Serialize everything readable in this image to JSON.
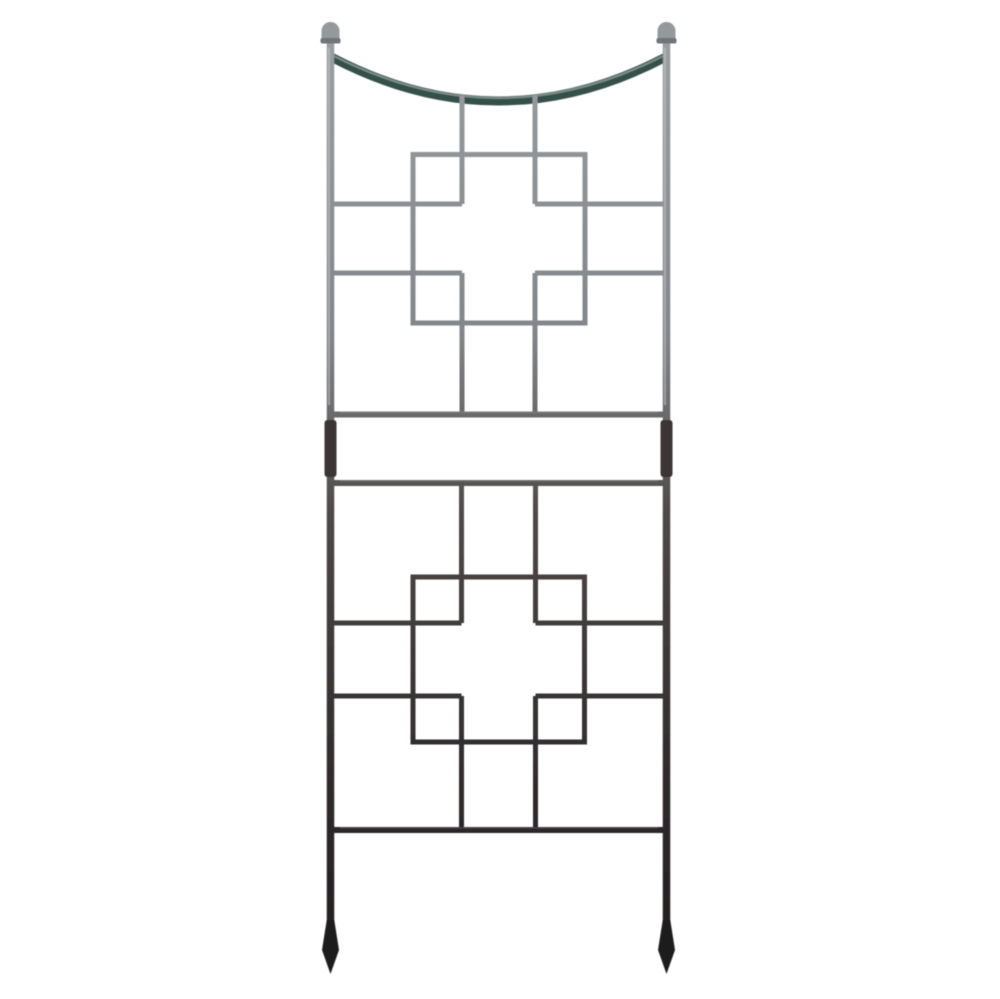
{
  "image": {
    "kind": "product-photo",
    "subject": "iron garden trellis",
    "alt": "Gunmetal iron garden trellis with dipped arched top, ball finials on two posts, two square-and-cross lattice panels, double middle rails with coupler sleeves, one bottom rail, and pointed spear feet",
    "background_color": "#ffffff"
  },
  "palette": {
    "metal_top": "#9da1a2",
    "metal_upper": "#83868a",
    "metal_mid": "#4d4847",
    "metal_lower": "#322e2f",
    "metal_bottom": "#1f1b1e",
    "arch": "#36504a",
    "arch_sheen": "#93a49d",
    "sheen": "#c9cdce",
    "rail_sheen": "#8f8c8a",
    "finial": "#94999b",
    "finial_collar": "#6f7476",
    "sleeve": "#3a3635"
  },
  "structure": {
    "posts": 2,
    "finials": 2,
    "lattice_panels": 2,
    "middle_rails": 2,
    "bottom_rails": 1,
    "coupler_sleeves": 2,
    "spear_feet": 2,
    "pattern": "square-on-cross lattice"
  }
}
